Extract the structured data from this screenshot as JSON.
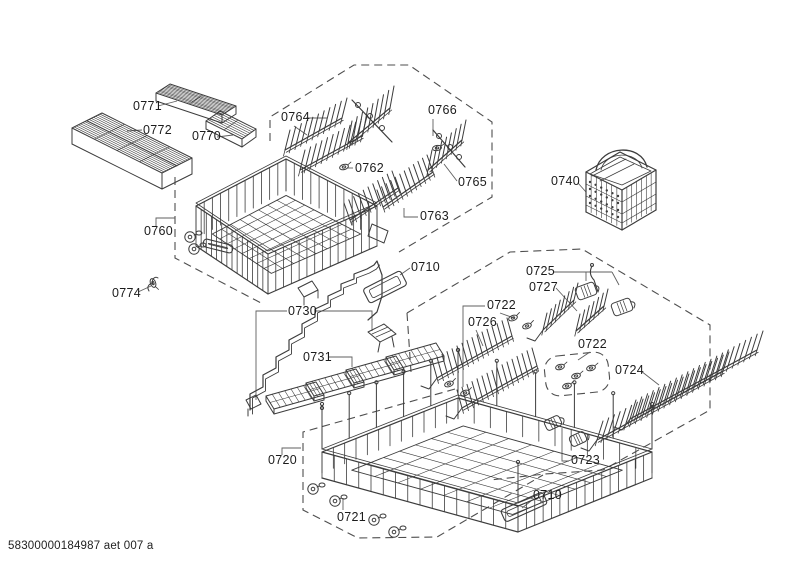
{
  "diagram": {
    "footer": "58300000184987 aet 007 a",
    "line_color": "#3c3c3c",
    "background_color": "#ffffff",
    "labels": [
      {
        "id": "0771",
        "text": "0771"
      },
      {
        "id": "0772",
        "text": "0772"
      },
      {
        "id": "0770",
        "text": "0770"
      },
      {
        "id": "0760",
        "text": "0760"
      },
      {
        "id": "0774",
        "text": "0774"
      },
      {
        "id": "0764",
        "text": "0764"
      },
      {
        "id": "0762",
        "text": "0762"
      },
      {
        "id": "0766",
        "text": "0766"
      },
      {
        "id": "0765",
        "text": "0765"
      },
      {
        "id": "0763",
        "text": "0763"
      },
      {
        "id": "0740",
        "text": "0740"
      },
      {
        "id": "0710-upper",
        "text": "0710"
      },
      {
        "id": "0730",
        "text": "0730"
      },
      {
        "id": "0731",
        "text": "0731"
      },
      {
        "id": "0725",
        "text": "0725"
      },
      {
        "id": "0727",
        "text": "0727"
      },
      {
        "id": "0722-left",
        "text": "0722"
      },
      {
        "id": "0726",
        "text": "0726"
      },
      {
        "id": "0722-right",
        "text": "0722"
      },
      {
        "id": "0724",
        "text": "0724"
      },
      {
        "id": "0723",
        "text": "0723"
      },
      {
        "id": "0720",
        "text": "0720"
      },
      {
        "id": "0721",
        "text": "0721"
      },
      {
        "id": "0710-lower",
        "text": "0710"
      }
    ]
  }
}
